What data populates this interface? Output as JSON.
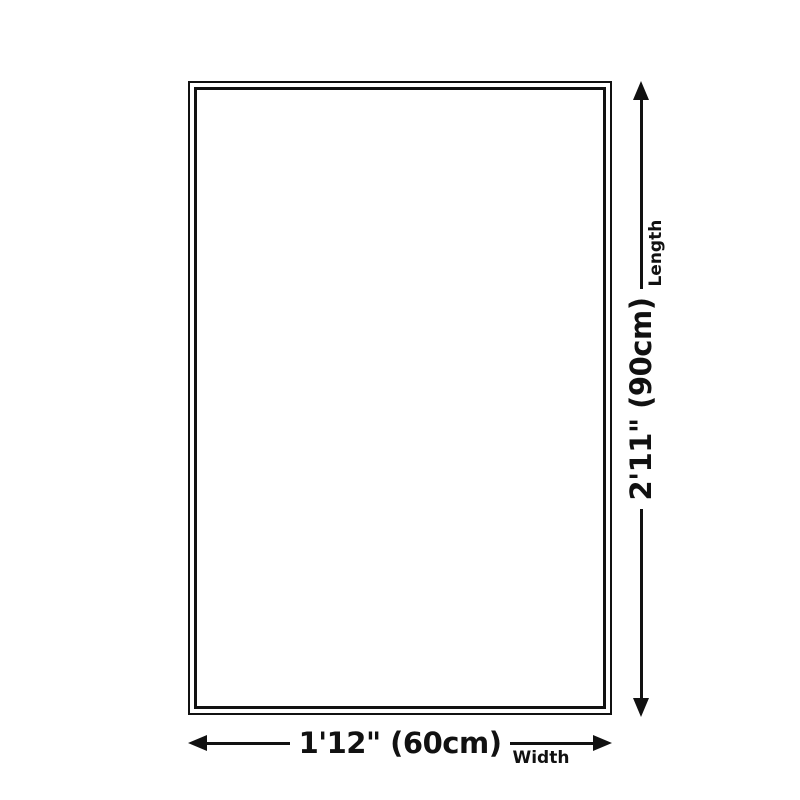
{
  "diagram": {
    "type": "product-size-diagram",
    "colors": {
      "line": "#111111",
      "background": "#ffffff"
    },
    "rug": {
      "shape": "rectangle",
      "border_style": "double"
    },
    "width_dimension": {
      "value": "1'12\" (60cm)",
      "label": "Width"
    },
    "length_dimension": {
      "value": "2'11\" (90cm)",
      "label": "Length"
    }
  }
}
